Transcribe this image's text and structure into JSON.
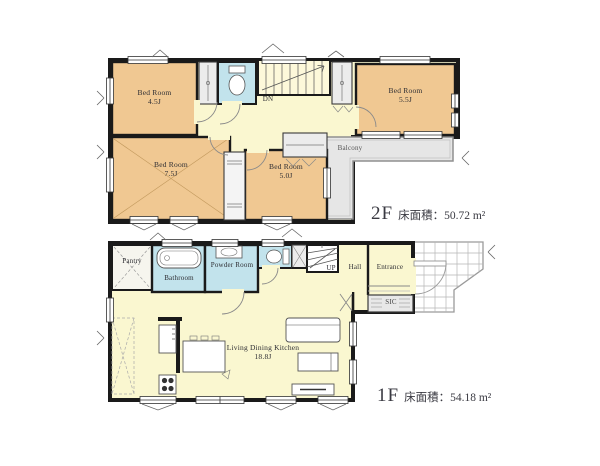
{
  "floor2": {
    "floor_label": "2F",
    "area_label": "床面積：50.72 m²",
    "bedroom_top_left": {
      "name": "Bed Room",
      "size": "4.5J"
    },
    "bedroom_top_right": {
      "name": "Bed Room",
      "size": "5.5J"
    },
    "bedroom_bottom_left": {
      "name": "Bed Room",
      "size": "7.5J"
    },
    "bedroom_bottom_mid": {
      "name": "Bed Room",
      "size": "5.0J"
    },
    "balcony_label": "Balcony",
    "stairs_label": "DN"
  },
  "floor1": {
    "floor_label": "1F",
    "area_label": "床面積：54.18 m²",
    "pantry_label": "Pantry",
    "bathroom_label": "Bathroom",
    "powder_label": "Powder Room",
    "stairs_label": "UP",
    "hall_label": "Hall",
    "entrance_label": "Entrance",
    "sic_label": "SIC",
    "ldk": {
      "name": "Living Dining Kitchen",
      "size": "18.8J"
    }
  },
  "colors": {
    "room_orange": "#f0c892",
    "corridor_yellow": "#faf7d0",
    "stairs_yellow": "#fdf8da",
    "wet_area_blue": "#c2e3ec",
    "closet_gray": "#ececec",
    "balcony_gray": "#e6e6e6",
    "wall_black": "#1a1a1a"
  }
}
